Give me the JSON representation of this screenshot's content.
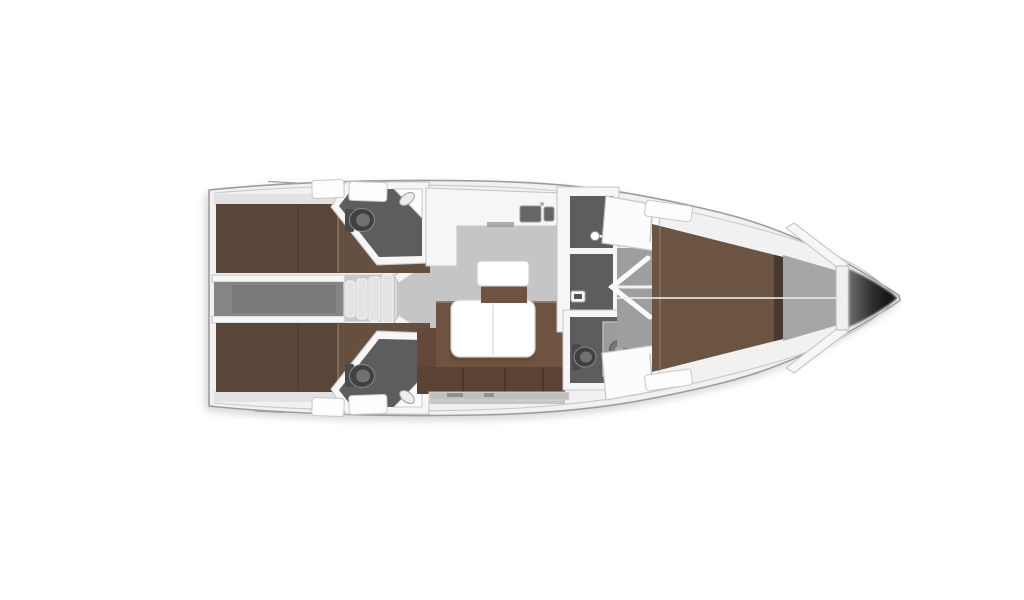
{
  "page": {
    "background": "#ffffff"
  },
  "diagram": {
    "type": "yacht-interior-floor-plan",
    "view": "top-down",
    "orientation": "bow-pointing-right",
    "areas": [
      {
        "id": "aft-cabin-port",
        "kind": "cabin",
        "furniture": [
          "double-berth",
          "shelf"
        ]
      },
      {
        "id": "aft-cabin-starboard",
        "kind": "cabin",
        "furniture": [
          "double-berth",
          "shelf"
        ]
      },
      {
        "id": "companionway",
        "kind": "entry",
        "furniture": [
          "steps",
          "engine-compartment"
        ]
      },
      {
        "id": "aft-head-port",
        "kind": "bathroom",
        "furniture": [
          "toilet",
          "corner-washbasin"
        ]
      },
      {
        "id": "aft-head-starboard",
        "kind": "bathroom",
        "furniture": [
          "toilet",
          "corner-washbasin"
        ]
      },
      {
        "id": "galley",
        "kind": "kitchen",
        "furniture": [
          "l-shaped-counter",
          "double-sink"
        ]
      },
      {
        "id": "salon",
        "kind": "living-area",
        "furniture": [
          "l-shaped-sofa",
          "folding-table",
          "seat",
          "sideboard"
        ]
      },
      {
        "id": "mid-head",
        "kind": "bathroom",
        "furniture": [
          "shower",
          "door-handle"
        ]
      },
      {
        "id": "mid-head-aft",
        "kind": "bathroom",
        "furniture": [
          "toilet",
          "shower-column"
        ]
      },
      {
        "id": "forward-cabin",
        "kind": "cabin",
        "furniture": [
          "v-berth",
          "locker-cabinet",
          "locker-cabinet",
          "open-door"
        ]
      },
      {
        "id": "bow",
        "kind": "anchor-locker",
        "furniture": [
          "bulkhead"
        ]
      }
    ]
  },
  "palette": {
    "background": "#ffffff",
    "hull_fill": "#f1f1f1",
    "hull_stroke": "#9c9c9c",
    "hull_inner_line": "#c9c9c9",
    "wall": "#f6f6f6",
    "wall_stroke": "#c6c6c6",
    "floor_light": "#c5c5c5",
    "floor_mid": "#9e9e9e",
    "floor_corridor": "#868686",
    "engine_hatch": "#7a7a7a",
    "floor_dark": "#5d5d5d",
    "steps": "#e4e4e4",
    "bed_dark": "#5a4638",
    "bed_mid": "#65503f",
    "bed_light": "#6b5442",
    "headboard": "#463931",
    "shelf": "#e2e2e2",
    "sofa": "#6f5340",
    "sofa_dark": "#5b4232",
    "sofa_arm": "#64493a",
    "table_white": "#ffffff",
    "furniture_stroke": "#cfcfcf",
    "fixture_dark": "#404040",
    "fixture_mid": "#717171",
    "fixture_light": "#9c9c9c",
    "locker_gray": "#a6a6a6",
    "bow_grad_start": "#6e6e6e",
    "bow_grad_mid": "#2d2d2d",
    "bow_grad_end": "#151515"
  }
}
